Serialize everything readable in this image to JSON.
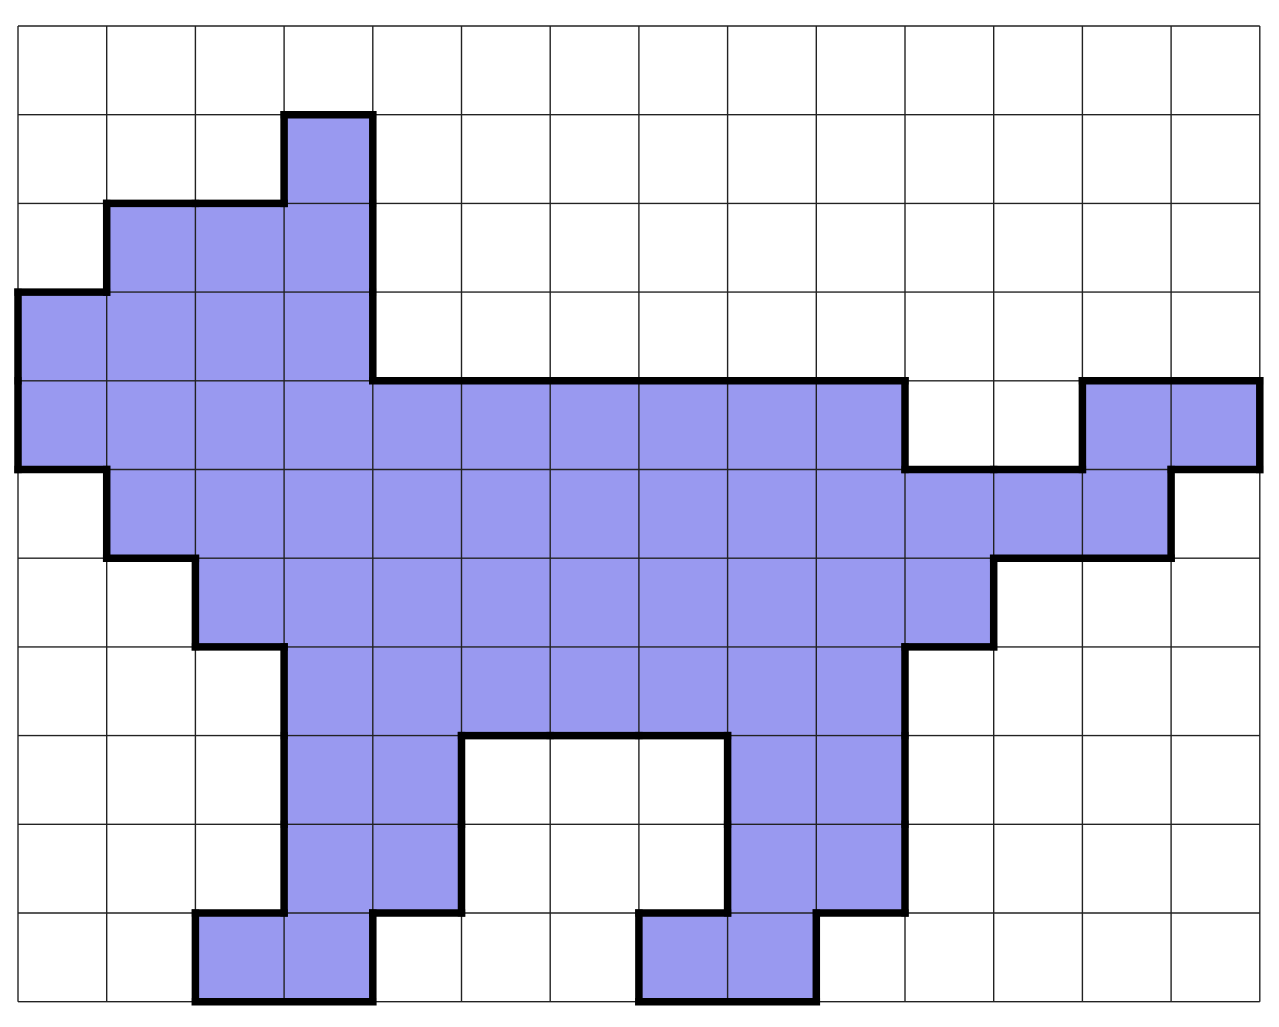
{
  "figure": {
    "title": "pixel-cat-on-grid",
    "grid": {
      "cols": 14,
      "rows": 11,
      "cell_size": 88.7,
      "origin_x": 18,
      "origin_y": 26,
      "width_px": 1279,
      "height_px": 1027
    },
    "colors": {
      "background": "#ffffff",
      "cell_fill": "#9999f0",
      "grid_line": "#222222",
      "outline": "#000000"
    },
    "stroke": {
      "grid_line_width": 1.4,
      "outline_width": 7.5
    },
    "filled_cells": [
      [
        1,
        3
      ],
      [
        2,
        1
      ],
      [
        2,
        2
      ],
      [
        2,
        3
      ],
      [
        3,
        0
      ],
      [
        3,
        1
      ],
      [
        3,
        2
      ],
      [
        3,
        3
      ],
      [
        4,
        0
      ],
      [
        4,
        1
      ],
      [
        4,
        2
      ],
      [
        4,
        3
      ],
      [
        4,
        4
      ],
      [
        4,
        5
      ],
      [
        4,
        6
      ],
      [
        4,
        7
      ],
      [
        4,
        8
      ],
      [
        4,
        9
      ],
      [
        4,
        12
      ],
      [
        4,
        13
      ],
      [
        5,
        1
      ],
      [
        5,
        2
      ],
      [
        5,
        3
      ],
      [
        5,
        4
      ],
      [
        5,
        5
      ],
      [
        5,
        6
      ],
      [
        5,
        7
      ],
      [
        5,
        8
      ],
      [
        5,
        9
      ],
      [
        5,
        10
      ],
      [
        5,
        11
      ],
      [
        5,
        12
      ],
      [
        6,
        2
      ],
      [
        6,
        3
      ],
      [
        6,
        4
      ],
      [
        6,
        5
      ],
      [
        6,
        6
      ],
      [
        6,
        7
      ],
      [
        6,
        8
      ],
      [
        6,
        9
      ],
      [
        6,
        10
      ],
      [
        7,
        3
      ],
      [
        7,
        4
      ],
      [
        7,
        5
      ],
      [
        7,
        6
      ],
      [
        7,
        7
      ],
      [
        7,
        8
      ],
      [
        7,
        9
      ],
      [
        8,
        3
      ],
      [
        8,
        4
      ],
      [
        8,
        8
      ],
      [
        8,
        9
      ],
      [
        9,
        3
      ],
      [
        9,
        4
      ],
      [
        9,
        8
      ],
      [
        9,
        9
      ],
      [
        10,
        2
      ],
      [
        10,
        3
      ],
      [
        10,
        7
      ],
      [
        10,
        8
      ]
    ]
  }
}
